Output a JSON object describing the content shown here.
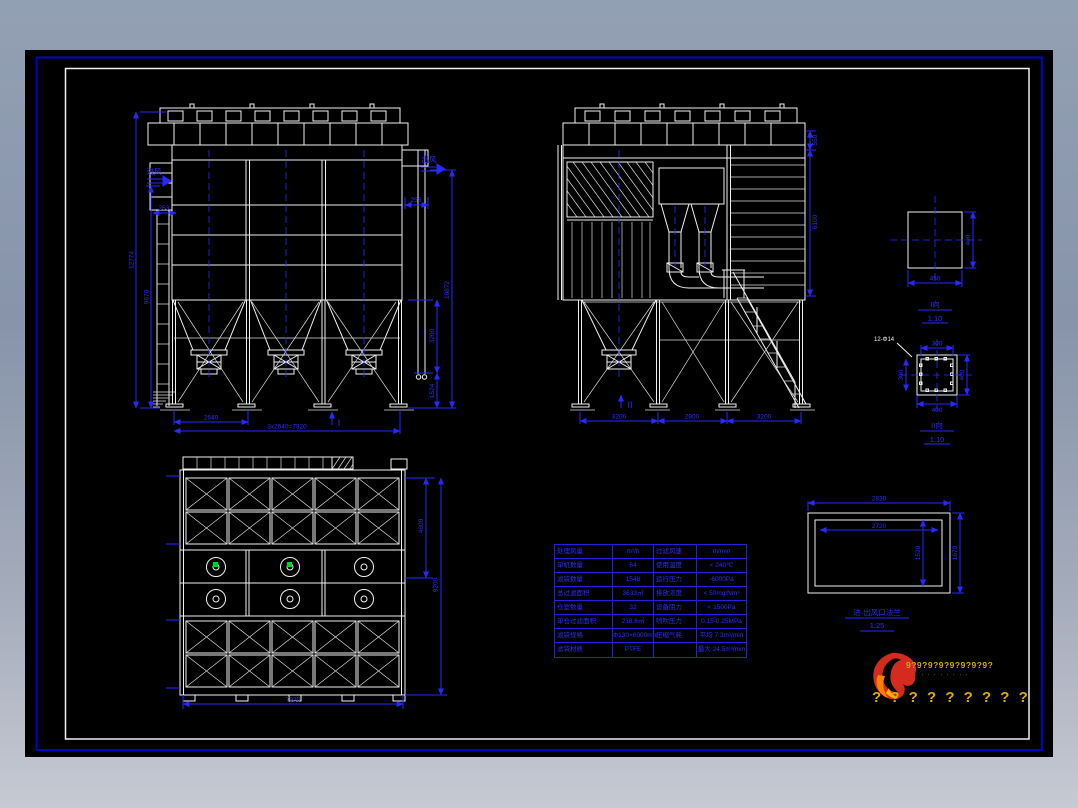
{
  "drawing": {
    "front_view": {
      "inlet_label": "进风",
      "outlet_label": "出风",
      "section_mark": "I",
      "dim_overall_height": "12774",
      "dim_body_height": "9670",
      "dim_inlet": "253",
      "dim_outlet": "253",
      "dim_right_height": "10872",
      "dim_hopper": "3200",
      "dim_leg": "1524",
      "dim_bay": "2640",
      "dim_total": "3x2640=7920"
    },
    "side_view": {
      "section_mark": "II",
      "dim_roof": "550",
      "dim_body": "6100",
      "dim_bay1": "3200",
      "dim_bay2": "2800",
      "dim_bay3": "3200"
    },
    "plan_view": {
      "dim_half_depth": "4600",
      "dim_depth": "9200",
      "dim_width": "7920"
    },
    "detail_I": {
      "caption": "I向",
      "scale": "1:10",
      "dim_width": "450",
      "dim_height": "400"
    },
    "detail_II": {
      "caption": "II向",
      "scale": "1:10",
      "note": "12-Φ14",
      "dim_top": "300",
      "dim_left": "300",
      "dim_right": "400",
      "dim_bottom": "400"
    },
    "flange_detail": {
      "caption": "进·出风口法兰",
      "scale": "1:25",
      "dim_outer_w": "2820",
      "dim_inner_w": "2720",
      "dim_inner_h": "1520",
      "dim_outer_h": "1670"
    }
  },
  "spec_table": {
    "rows": [
      {
        "l_label": "处理风量",
        "l_value": "m³/h",
        "r_label": "过滤风速",
        "r_value": "m/min"
      },
      {
        "l_label": "单机数量",
        "l_value": "64",
        "r_label": "使用温度",
        "r_value": "< 240℃"
      },
      {
        "l_label": "滤袋数量",
        "l_value": "1548",
        "r_label": "运行压力",
        "r_value": "-6000Pa"
      },
      {
        "l_label": "总过滤面积",
        "l_value": "3633㎡",
        "r_label": "排放浓度",
        "r_value": "< 50mg/Nm³"
      },
      {
        "l_label": "仓室数量",
        "l_value": "32",
        "r_label": "设备阻力",
        "r_value": "< 1500Pa"
      },
      {
        "l_label": "单仓过滤面积",
        "l_value": "218.6㎡",
        "r_label": "喷吹压力",
        "r_value": "0.15-0.25MPa"
      },
      {
        "l_label": "滤袋规格",
        "l_value": "Φ130×6000mm",
        "r_label": "压缩气耗",
        "r_value": "平均 7.3m³/min"
      },
      {
        "l_label": "滤袋材质",
        "l_value": "PTFE",
        "r_label": "",
        "r_value": "最大 24.5m³/min"
      }
    ]
  },
  "logo": {
    "line1": "9?9?9?9?9?9?9?9?",
    "line2": "' ' ' ' ' ' ' ' ' '",
    "line3": "? ? ? ? ? ? ? ? ?"
  },
  "colors": {
    "line_white": "#f0f0f0",
    "dim_blue": "#2727ff",
    "frame_blue": "#0000cc",
    "accent_green": "#00d51f",
    "logo_red": "#d42b1e",
    "logo_orange": "#ff7f00",
    "logo_gold": "#d6a516"
  }
}
